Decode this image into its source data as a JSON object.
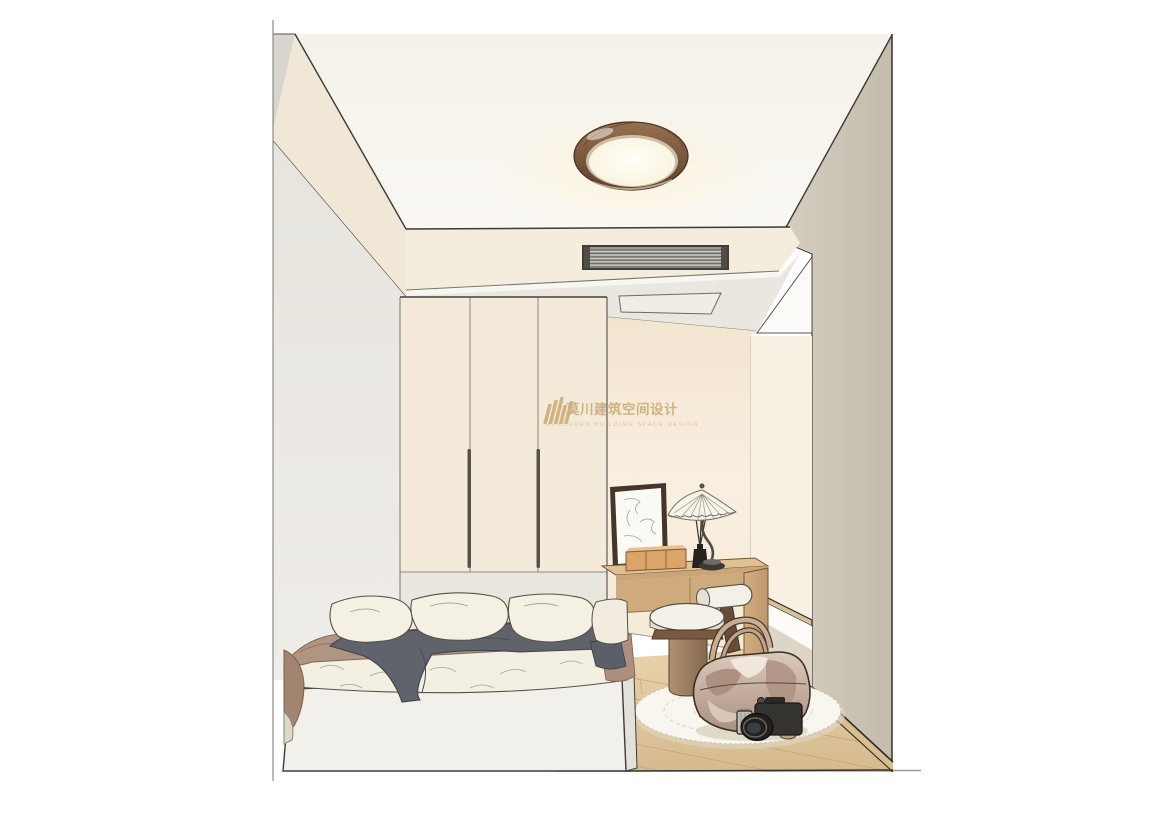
{
  "watermark": {
    "chinese": "莫川建筑空间设计",
    "english": "MOKCHUEN BUILDING SPACE DESIGN"
  },
  "palette": {
    "brand_gold": "#c8a56c",
    "brand_gold_light": "#d4ba8e",
    "outline_ink": "#3c3a35",
    "ceiling_white": "#f7f5ef",
    "soffit_cream": "#f1e7d6",
    "bulkhead_cream": "#f4ecdd",
    "wall_warm_cream": "#f6e9d6",
    "wall_left_gray": "#edebe5",
    "wall_cut_greige": "#cdc5b6",
    "wardrobe_cream": "#f3ead9",
    "wood_desk": "#cba77a",
    "wood_floor": "#ddc49c",
    "skirting_wood": "#d7bd92",
    "lamp_rim_walnut": "#7e5c43",
    "bedding_white": "#f3efe3",
    "bedding_taupe": "#b29482",
    "bedding_gray": "#60636b",
    "stool_leather": "#a08468",
    "bag_leather": "#c7b0a1",
    "rug_white": "#f8f6ef"
  }
}
